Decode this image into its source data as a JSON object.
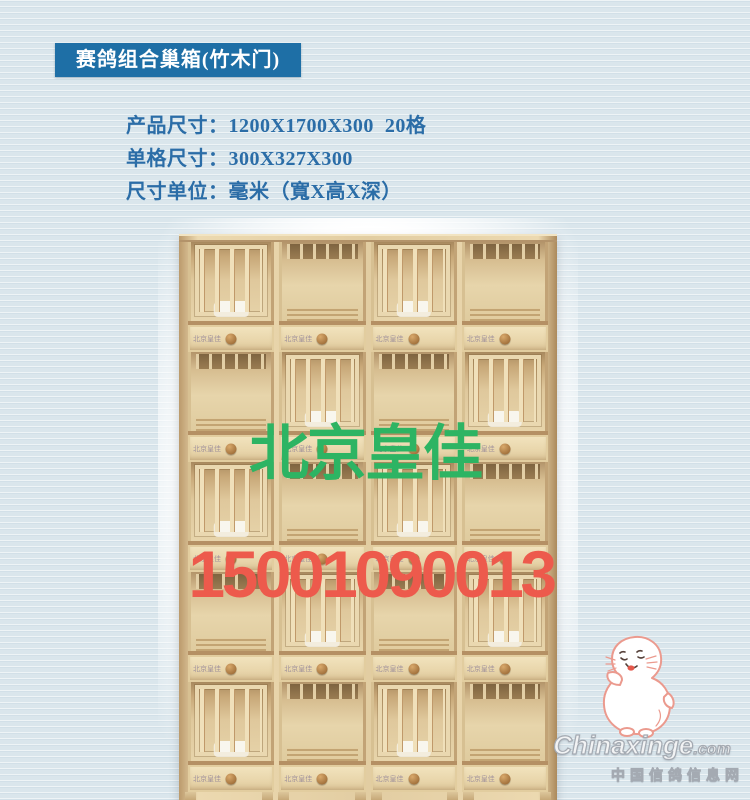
{
  "title_badge": {
    "text": "赛鸽组合巢箱(竹木门)"
  },
  "specs": {
    "lines": [
      "产品尺寸：1200X1700X300  20格",
      "单格尺寸：300X327X300",
      "尺寸单位：毫米（寬X高X深）"
    ]
  },
  "product_photo": {
    "description": "light wooden racing-pigeon nest-box cabinet, 4 columns x 5 rows of compartments, alternating barred doors and open cells, drawer strip with round knob under every compartment, short legs at base",
    "columns": 4,
    "rows": 5,
    "door_pattern": [
      [
        "closed",
        "open",
        "closed",
        "open"
      ],
      [
        "open",
        "closed",
        "open",
        "closed"
      ],
      [
        "closed",
        "open",
        "closed",
        "open"
      ],
      [
        "open",
        "closed",
        "open",
        "closed"
      ],
      [
        "closed",
        "open",
        "closed",
        "open"
      ]
    ],
    "drawer_stamp": "北京皇佳"
  },
  "watermarks": {
    "brand_green": "北京皇佳",
    "phone_red": "15001090013",
    "site_name": "Chinaxinge",
    "site_tld": ".com",
    "site_cn": "中国信鸽信息网"
  },
  "colors": {
    "page_bg": "#dae6ec",
    "badge_bg": "#1e6fa6",
    "spec_text": "#2b6da7",
    "brand_green": "#2db463",
    "phone_red": "#ed5a4c",
    "wood_light": "#ecd9b0",
    "knob_brown": "#8f5e2c"
  }
}
